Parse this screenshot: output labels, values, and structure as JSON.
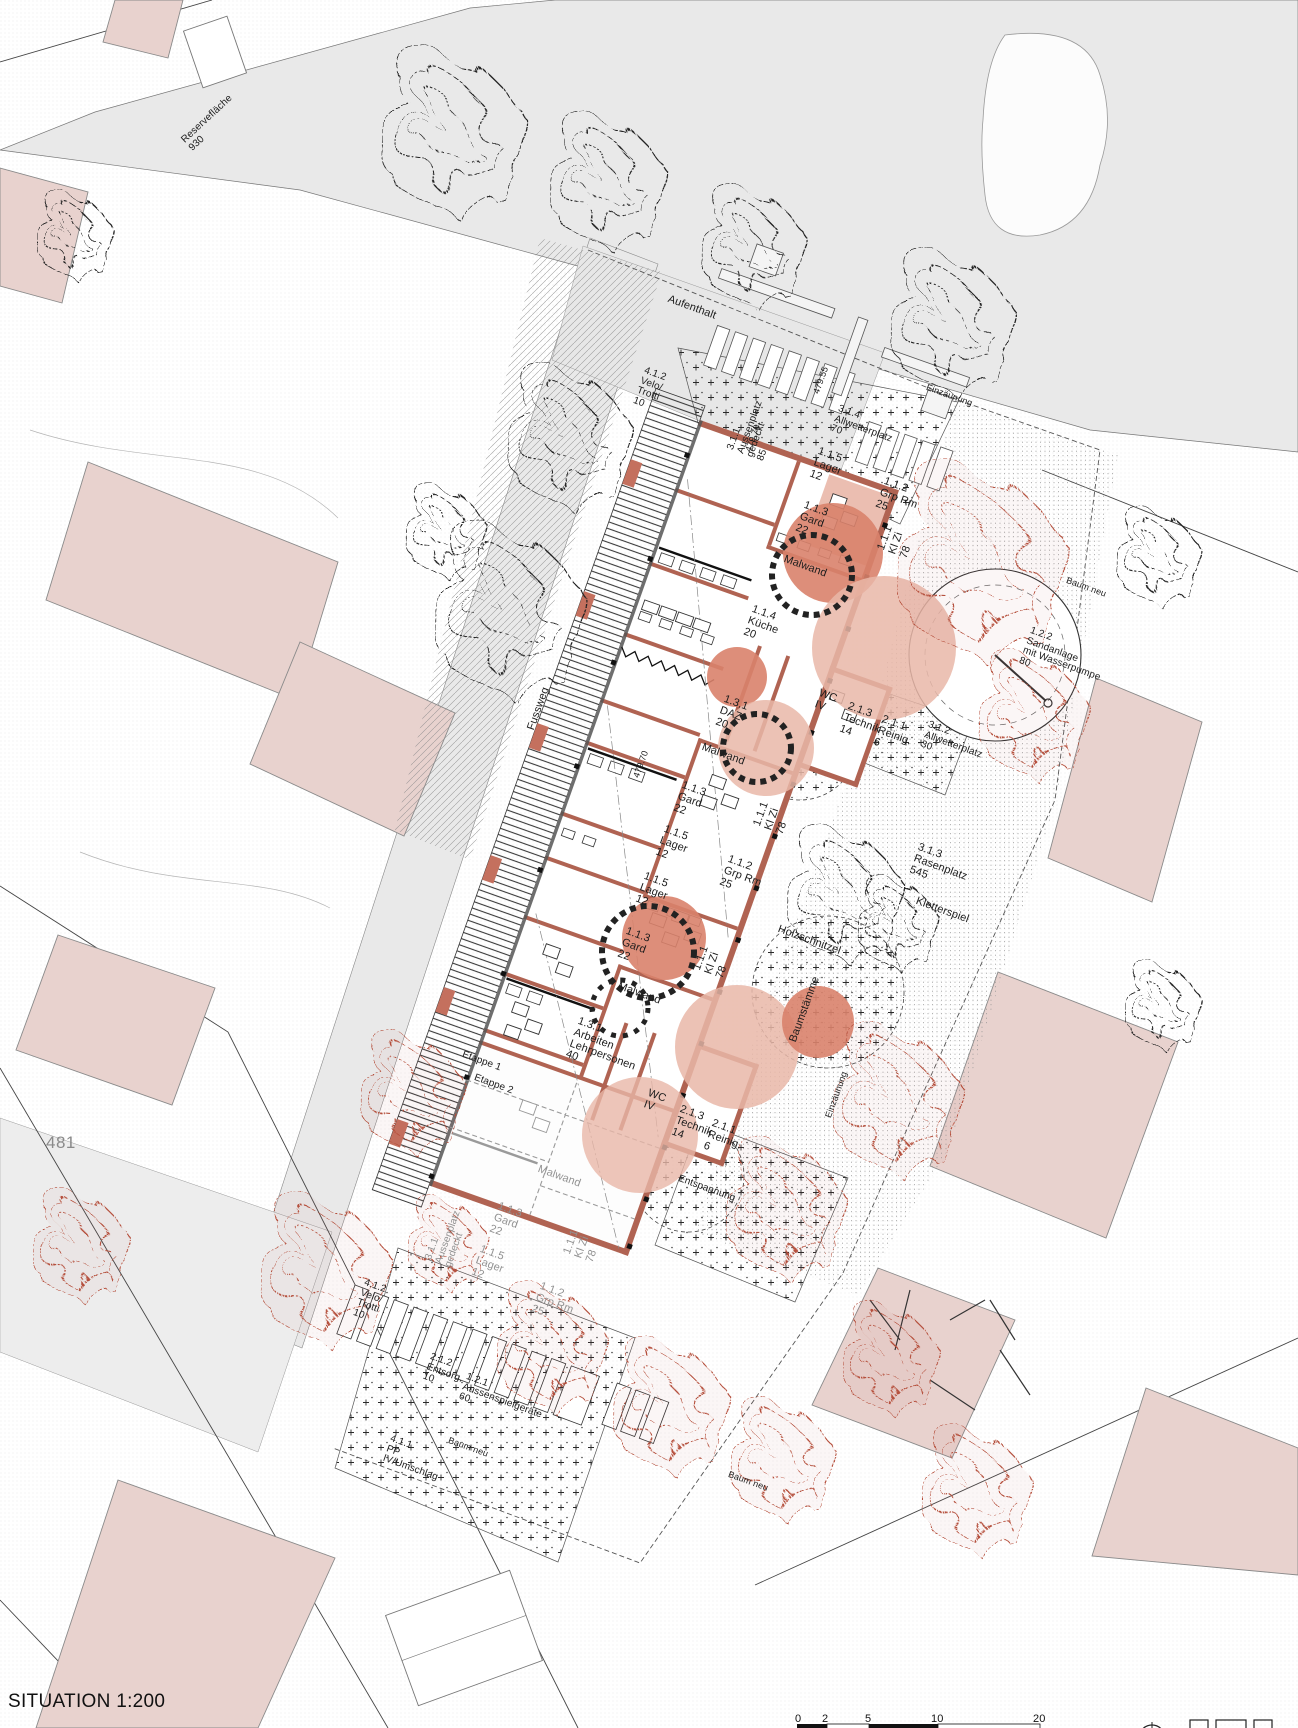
{
  "title": "SITUATION 1:200",
  "parcel_number": "481",
  "colors": {
    "wall_red": "#b06352",
    "salmon_dark": "#d9826c",
    "salmon_light": "#e9b7a8",
    "neighbor_building_pink": "#e8d2ce",
    "tree_red": "#b5503c",
    "road_grey": "#e9e9e9",
    "etappe2_grey": "#929292"
  },
  "scalebar": {
    "t1": "0",
    "t2": "2",
    "t3": "5",
    "t4": "10",
    "t5": "20"
  },
  "rooms": {
    "lager": "1.1.5\nLager\n12",
    "grp_rm": "1.1.2\nGrp Rm\n25",
    "gard": "1.1.3\nGard\n22",
    "kl_zi": "1.1.1\nKl Zi\n78",
    "malwand": "Malwand",
    "kueche": "1.1.4\nKüche\n20",
    "daz": "1.3.1\nDAZ\n20",
    "wc": "WC\nIV",
    "technik": "2.1.3\nTechnik\n14",
    "reinig": "2.1.1\nReinig.\n6",
    "arbeiten": "1.3.1\nArbeiten\nLehrpersonen\n40"
  },
  "outdoor": {
    "aussenplatz": "3.1.1\nAussenplatz\ngedeckt\n85",
    "aussenplatz2": "3.1.1\nAussenplatz\ngedeckt",
    "allwetterplatz_70": "3.1.4\nAllwetterplatz\n70",
    "allwetterplatz_30": "3.1.2\nAllwetterplatz\n30",
    "rasenplatz": "3.1.3\nRasenplatz\n545",
    "kletterspiel": "Kletterspiel",
    "holzschnitzel": "Holzschnitzel",
    "baumstaemme": "Baumstämme",
    "sandanlage": "1.2.2\nSandanlage\nmit Wasserpumpe\n80",
    "aussenspielgeraete": "1.2.1\nAussenspielgeräte\n60",
    "entsorg": "2.1.2\nEntsorg.\n10",
    "pp": "4.1.1\nPP\nIV/Umschlag",
    "velo": "4.1.2\nVelo/\nTrotti\n10",
    "aufenthalt": "Aufenthalt",
    "reserveflaeche": "Reservefläche\n930",
    "fussweg": "Fussweg",
    "etappe1": "Etappe 1",
    "etappe2": "Etappe 2",
    "einzaeunung": "Einzäunung",
    "entspannung": "Entspannung",
    "baum_neu": "Baum neu",
    "elev_47955": "479.55",
    "elev_47970": "479.70"
  }
}
